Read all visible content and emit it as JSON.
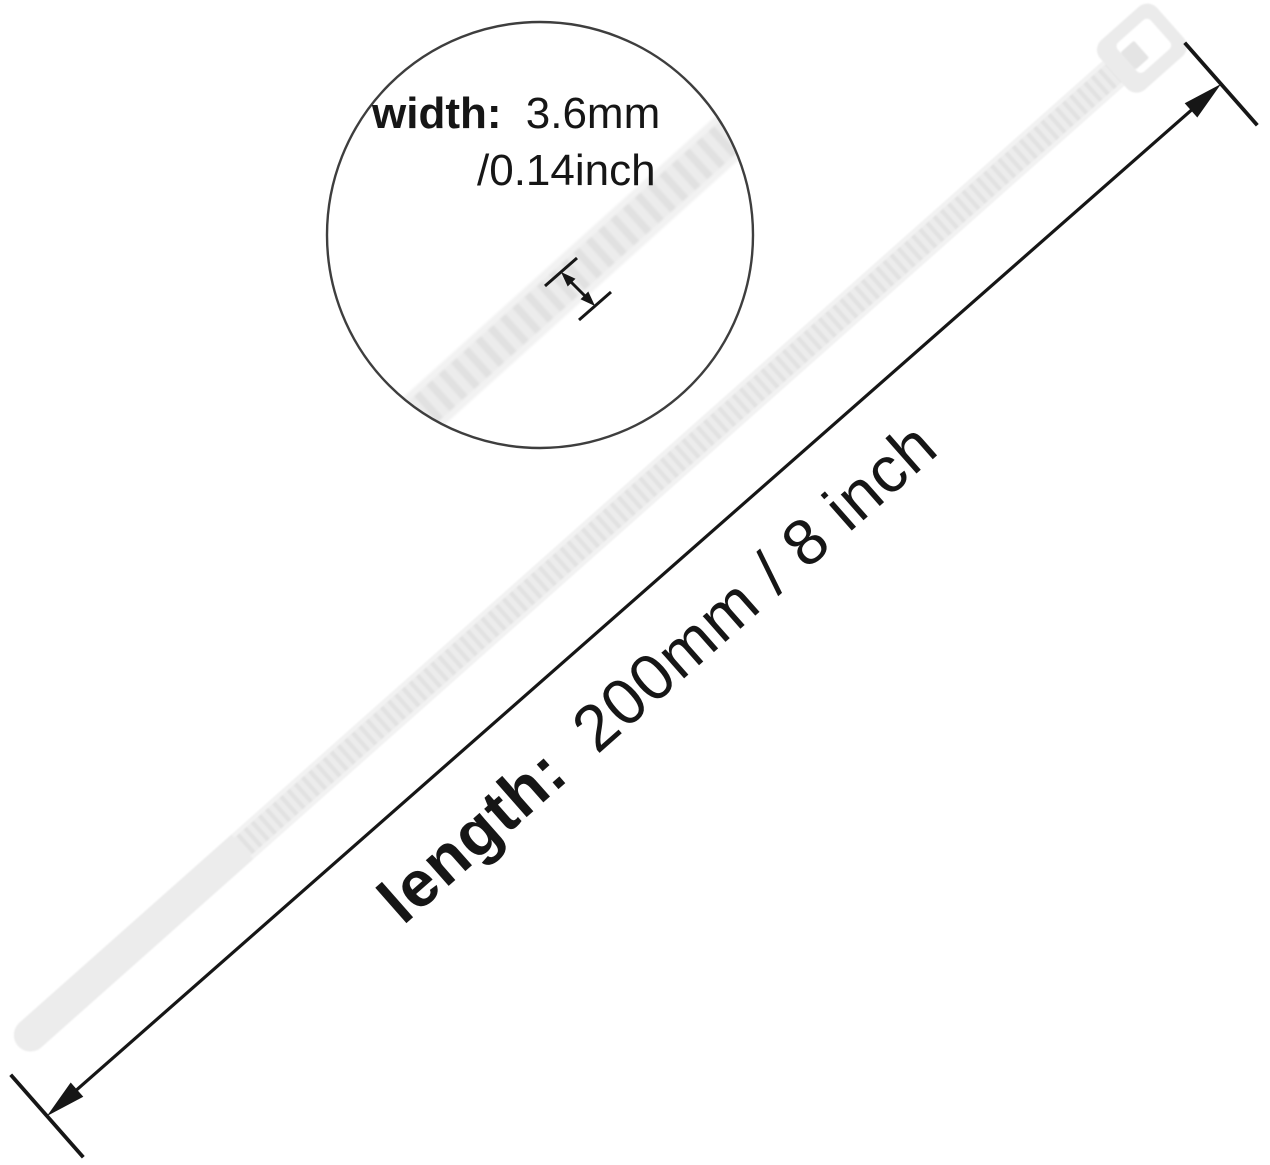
{
  "image": {
    "type": "product-dimension-diagram",
    "subject": "nylon cable zip tie",
    "background": "#ffffff"
  },
  "width_callout": {
    "label": "width:",
    "value_metric": "3.6mm",
    "value_imperial": "/0.14inch"
  },
  "length_dimension": {
    "label": "length:",
    "value": "200mm / 8 inch"
  },
  "colors": {
    "tie_body": "#ececec",
    "tie_rib": "#e2e2e2",
    "tie_rail": "#f2f2f2",
    "tie_head": "#ebebeb",
    "tie_pawl": "#e4e4e4",
    "annotation": "#161616",
    "lens_stroke": "#3e3e3e"
  }
}
